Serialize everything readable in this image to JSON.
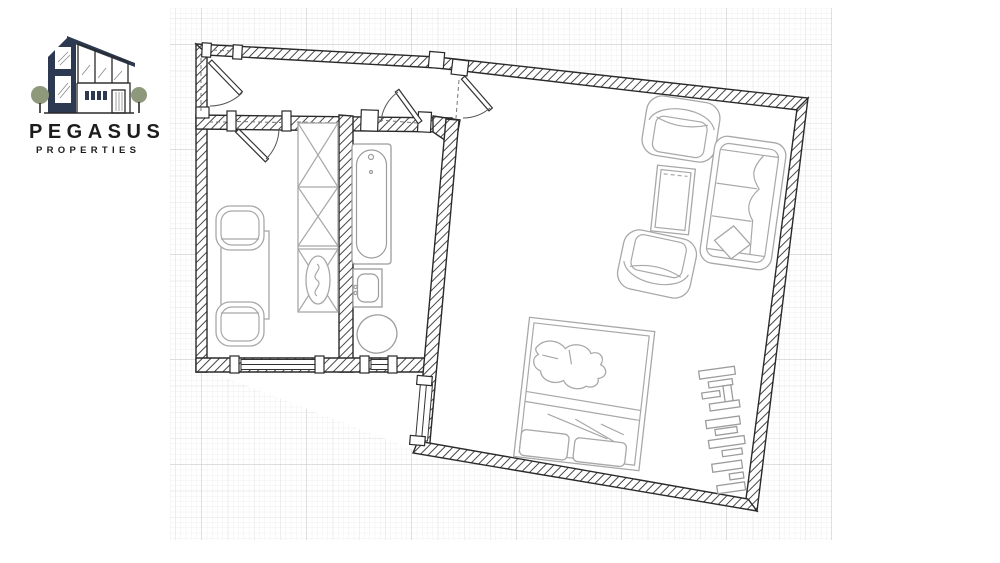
{
  "brand": {
    "name": "PEGASUS",
    "tagline": "PROPERTIES"
  },
  "palette": {
    "navy": "#2c3950",
    "tree_green": "#8e987b",
    "ink": "#1c1c1c",
    "wall_line": "#2a2a2a",
    "hatch_line": "#474747",
    "furniture_line": "#a8a8a8",
    "fixture_line": "#9c9c9c",
    "grid_minor": "#efefef",
    "grid_medium": "#e3e3e3",
    "grid_major": "#cbcbcb",
    "paper": "#ffffff"
  },
  "floorplan": {
    "type": "apartment-floor-plan",
    "style": "blueprint on graph paper, hatched walls, no dimension labels",
    "rooms": [
      {
        "name": "hallway",
        "furniture": []
      },
      {
        "name": "study-dining-room",
        "furniture": [
          "table",
          "chair",
          "chair",
          "wardrobe-with-mirror-cabinet"
        ]
      },
      {
        "name": "bathroom",
        "furniture": [
          "bathtub",
          "washbasin",
          "toilet"
        ]
      },
      {
        "name": "living-bedroom",
        "furniture": [
          "armchair",
          "armchair",
          "coffee-table",
          "sofa",
          "double-bed",
          "shelving-unit"
        ]
      }
    ],
    "doors": [
      "entry-door",
      "study-door",
      "bathroom-door",
      "living-room-door"
    ],
    "window_count": 3
  }
}
